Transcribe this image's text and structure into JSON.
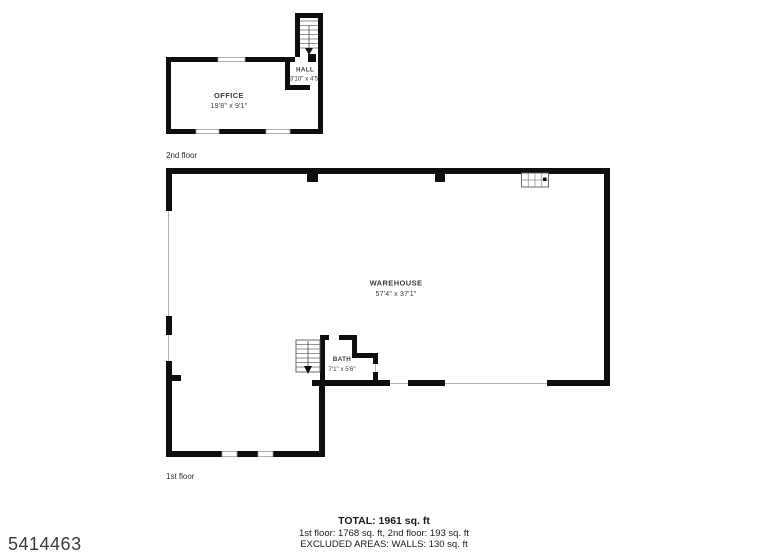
{
  "listing_number": "5414463",
  "colors": {
    "background": "#ffffff",
    "wall": "#0e0e0e",
    "window_outline": "#9b9b9b",
    "room_text": "#3a3a3a",
    "summary_text": "#1c1c1c",
    "watermark_text": "#3a3a3a"
  },
  "floors": {
    "second": {
      "label": "2nd floor",
      "office": {
        "name": "OFFICE",
        "dims": "19'8\" x 9'1\""
      },
      "hall": {
        "name": "HALL",
        "dims": "3'10\" x 4'5\""
      }
    },
    "first": {
      "label": "1st floor",
      "warehouse": {
        "name": "WAREHOUSE",
        "dims": "57'4\" x 37'1\""
      },
      "bath": {
        "name": "BATH",
        "dims": "7'1\" x 5'6\""
      }
    }
  },
  "summary": {
    "total": "TOTAL: 1961 sq. ft",
    "floor_breakdown": "1st floor: 1768 sq. ft, 2nd floor: 193 sq. ft",
    "excluded": "EXCLUDED AREAS: WALLS: 130 sq. ft"
  }
}
